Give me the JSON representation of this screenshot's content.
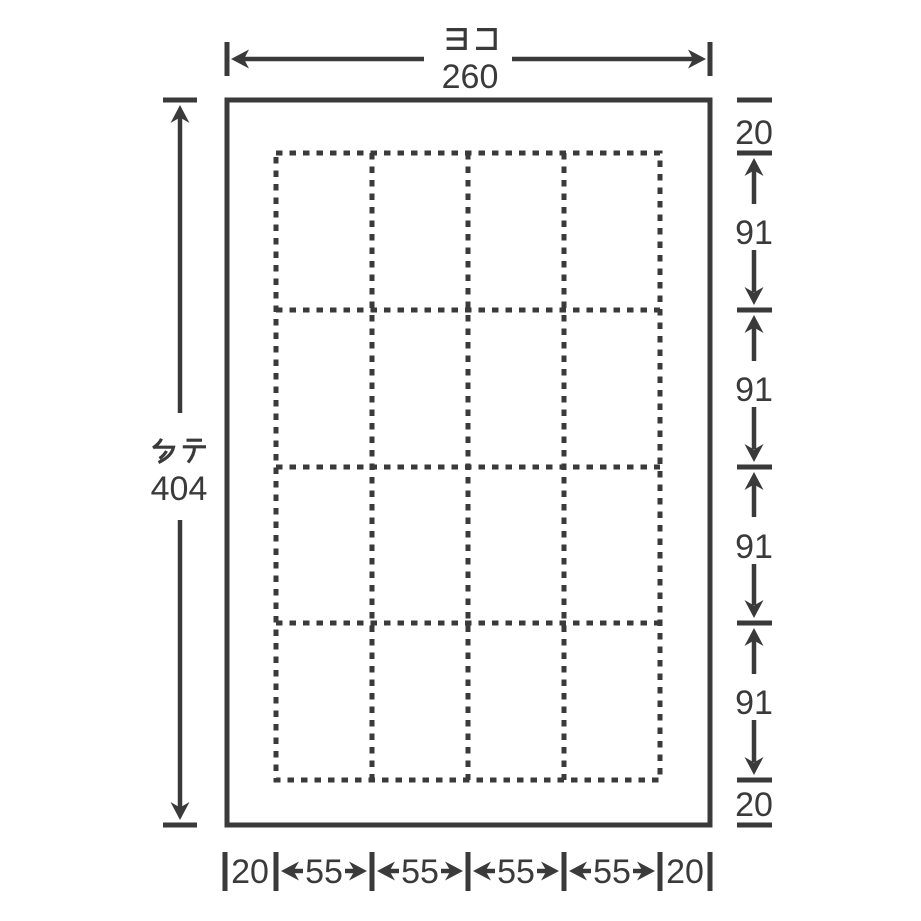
{
  "dimensions": {
    "top": {
      "label": "ヨコ",
      "value": "260"
    },
    "left": {
      "label": "タテ",
      "value": "404"
    },
    "right": {
      "values": [
        "20",
        "91",
        "91",
        "91",
        "91",
        "20"
      ]
    },
    "bottom": {
      "values": [
        "20",
        "55",
        "55",
        "55",
        "55",
        "20"
      ]
    }
  },
  "grid": {
    "rows": 4,
    "columns": 4,
    "cell_count": 16
  },
  "colors": {
    "line": "#3a3a3a",
    "background": "#ffffff"
  }
}
